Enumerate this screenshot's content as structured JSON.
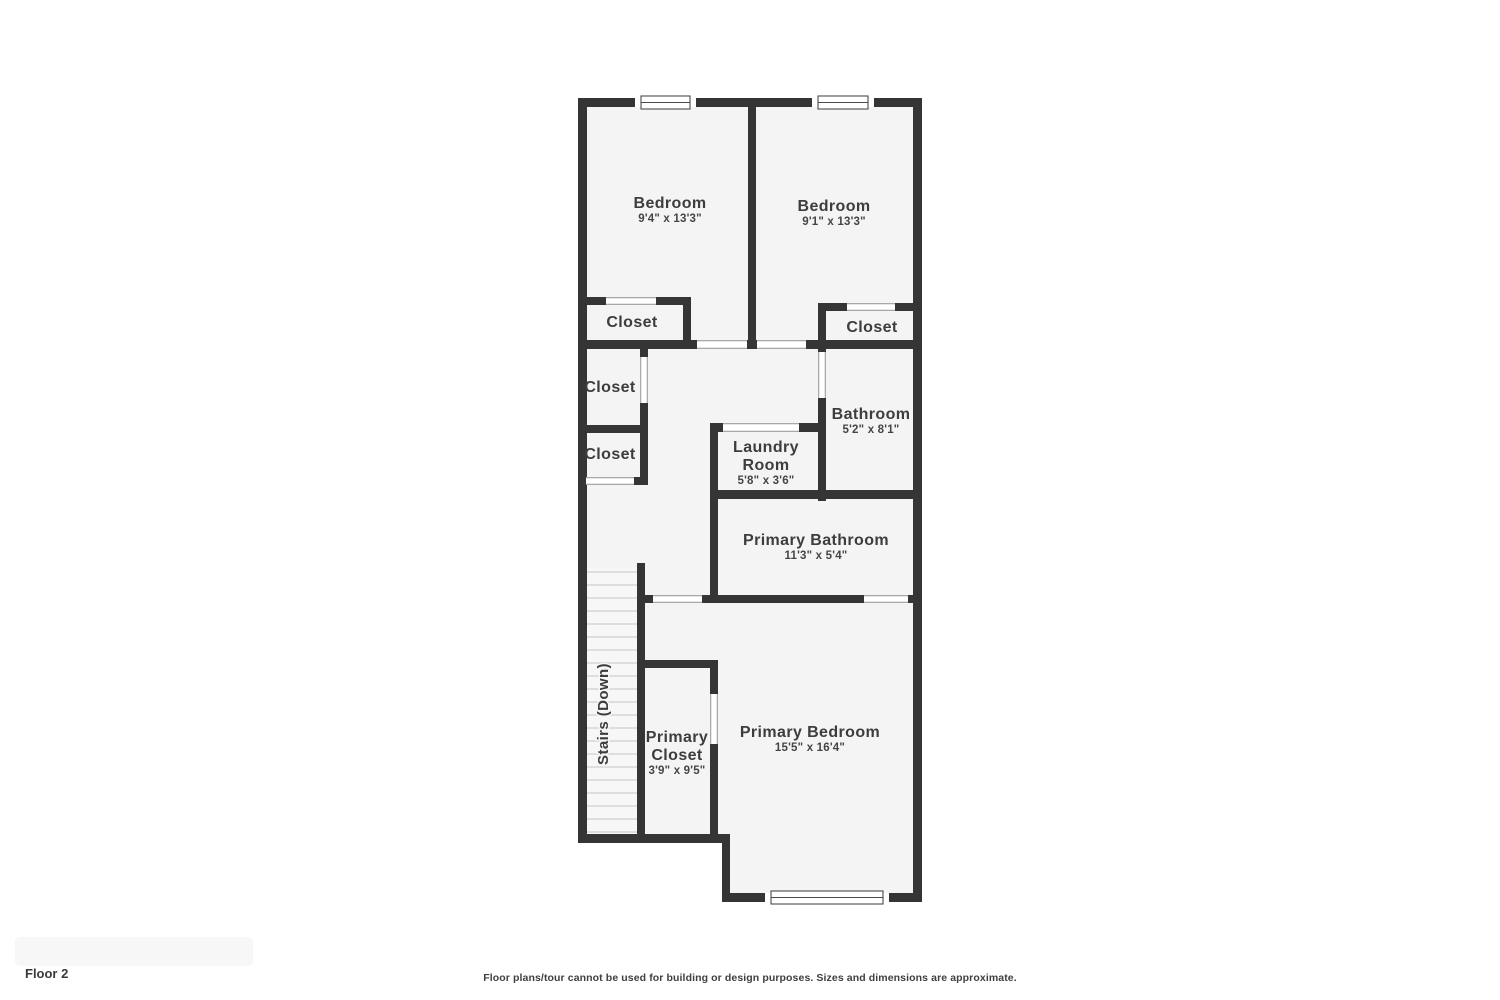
{
  "footer": {
    "floor_label": "Floor 2",
    "disclaimer": "Floor plans/tour cannot be used for building or design purposes. Sizes and dimensions are approximate."
  },
  "colors": {
    "background": "#ffffff",
    "wall": "#353535",
    "floor": "#f4f4f4",
    "stair_floor": "#f7f7f7",
    "tread": "#d6d6d6",
    "door_edge": "#9c9c9c",
    "window_frame": "#4a4a4a",
    "text": "#3d3d3d"
  },
  "plan": {
    "floor_outline": "578,98 922,98 922,902 722,902 722,843 578,843",
    "walls": [
      {
        "x": 578,
        "y": 98,
        "w": 344,
        "h": 9
      },
      {
        "x": 578,
        "y": 98,
        "w": 9,
        "h": 745
      },
      {
        "x": 913,
        "y": 98,
        "w": 9,
        "h": 804
      },
      {
        "x": 748,
        "y": 98,
        "w": 8,
        "h": 251
      },
      {
        "x": 578,
        "y": 297,
        "w": 113,
        "h": 8
      },
      {
        "x": 683,
        "y": 297,
        "w": 8,
        "h": 52
      },
      {
        "x": 818,
        "y": 303,
        "w": 104,
        "h": 8
      },
      {
        "x": 818,
        "y": 303,
        "w": 8,
        "h": 198
      },
      {
        "x": 578,
        "y": 340,
        "w": 344,
        "h": 9
      },
      {
        "x": 640,
        "y": 347,
        "w": 8,
        "h": 86
      },
      {
        "x": 578,
        "y": 425,
        "w": 70,
        "h": 8
      },
      {
        "x": 640,
        "y": 433,
        "w": 8,
        "h": 52
      },
      {
        "x": 578,
        "y": 477,
        "w": 70,
        "h": 8
      },
      {
        "x": 710,
        "y": 423,
        "w": 110,
        "h": 9
      },
      {
        "x": 710,
        "y": 423,
        "w": 8,
        "h": 180
      },
      {
        "x": 710,
        "y": 490,
        "w": 212,
        "h": 9
      },
      {
        "x": 637,
        "y": 563,
        "w": 8,
        "h": 280
      },
      {
        "x": 637,
        "y": 595,
        "w": 285,
        "h": 8
      },
      {
        "x": 637,
        "y": 660,
        "w": 81,
        "h": 8
      },
      {
        "x": 710,
        "y": 660,
        "w": 8,
        "h": 183
      },
      {
        "x": 578,
        "y": 834,
        "w": 152,
        "h": 9
      },
      {
        "x": 722,
        "y": 834,
        "w": 8,
        "h": 68
      },
      {
        "x": 722,
        "y": 893,
        "w": 200,
        "h": 9
      }
    ],
    "doors": [
      {
        "x": 606,
        "y": 297,
        "w": 50,
        "h": 8,
        "o": "h"
      },
      {
        "x": 847,
        "y": 303,
        "w": 48,
        "h": 8,
        "o": "h"
      },
      {
        "x": 697,
        "y": 340,
        "w": 50,
        "h": 9,
        "o": "h"
      },
      {
        "x": 757,
        "y": 340,
        "w": 49,
        "h": 9,
        "o": "h"
      },
      {
        "x": 818,
        "y": 352,
        "w": 8,
        "h": 46,
        "o": "v"
      },
      {
        "x": 640,
        "y": 357,
        "w": 8,
        "h": 46,
        "o": "v"
      },
      {
        "x": 586,
        "y": 477,
        "w": 48,
        "h": 8,
        "o": "h"
      },
      {
        "x": 723,
        "y": 423,
        "w": 76,
        "h": 9,
        "o": "h"
      },
      {
        "x": 653,
        "y": 595,
        "w": 49,
        "h": 8,
        "o": "h"
      },
      {
        "x": 864,
        "y": 595,
        "w": 44,
        "h": 8,
        "o": "h"
      },
      {
        "x": 710,
        "y": 694,
        "w": 8,
        "h": 50,
        "o": "v"
      }
    ],
    "windows": [
      {
        "x": 641,
        "y": 96,
        "w": 49,
        "h": 13
      },
      {
        "x": 818,
        "y": 96,
        "w": 50,
        "h": 13
      },
      {
        "x": 771,
        "y": 891,
        "w": 112,
        "h": 13
      }
    ],
    "stairs": {
      "label": "Stairs (Down)",
      "x1": 587,
      "x2": 637,
      "top": 572,
      "bottom": 832,
      "steps": 21,
      "label_x": 608,
      "label_y": 714
    },
    "rooms": [
      {
        "id": "bedroom-1",
        "lines": [
          "Bedroom"
        ],
        "dims": "9'4\" x 13'3\"",
        "cx": 670,
        "cy": 208
      },
      {
        "id": "bedroom-2",
        "lines": [
          "Bedroom"
        ],
        "dims": "9'1\" x 13'3\"",
        "cx": 834,
        "cy": 211
      },
      {
        "id": "closet-bedroom-1",
        "lines": [
          "Closet"
        ],
        "dims": "",
        "cx": 632,
        "cy": 327
      },
      {
        "id": "closet-bedroom-2",
        "lines": [
          "Closet"
        ],
        "dims": "",
        "cx": 872,
        "cy": 332
      },
      {
        "id": "closet-hall-upper",
        "lines": [
          "Closet"
        ],
        "dims": "",
        "cx": 610,
        "cy": 392
      },
      {
        "id": "bathroom",
        "lines": [
          "Bathroom"
        ],
        "dims": "5'2\" x 8'1\"",
        "cx": 871,
        "cy": 419
      },
      {
        "id": "closet-hall-lower",
        "lines": [
          "Closet"
        ],
        "dims": "",
        "cx": 610,
        "cy": 459
      },
      {
        "id": "laundry-room",
        "lines": [
          "Laundry",
          "Room"
        ],
        "dims": "5'8\" x 3'6\"",
        "cx": 766,
        "cy": 452
      },
      {
        "id": "primary-bathroom",
        "lines": [
          "Primary Bathroom"
        ],
        "dims": "11'3\" x 5'4\"",
        "cx": 816,
        "cy": 545
      },
      {
        "id": "primary-closet",
        "lines": [
          "Primary",
          "Closet"
        ],
        "dims": "3'9\" x 9'5\"",
        "cx": 677,
        "cy": 742
      },
      {
        "id": "primary-bedroom",
        "lines": [
          "Primary Bedroom"
        ],
        "dims": "15'5\" x 16'4\"",
        "cx": 810,
        "cy": 737
      }
    ]
  }
}
